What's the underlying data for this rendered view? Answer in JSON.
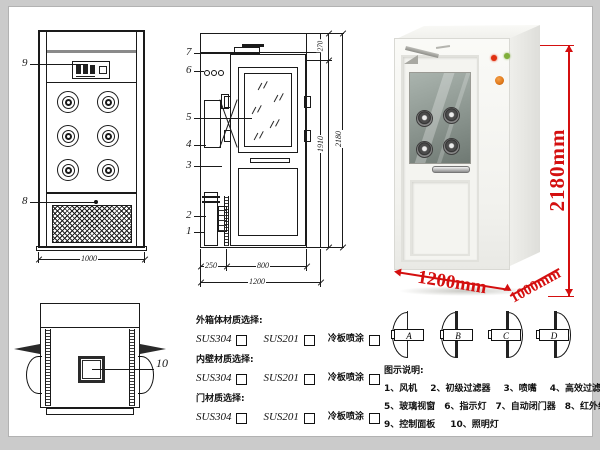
{
  "colors": {
    "line": "#1a1a1a",
    "dimension_red": "#d40f0f",
    "indicator_red": "#e03010",
    "indicator_green": "#7fae3a",
    "button_orange": "#e07818",
    "glass": "#8e9a94"
  },
  "front_view": {
    "label_9": "9",
    "label_8": "8",
    "width_dim": "1000"
  },
  "side_view": {
    "labels": [
      "7",
      "6",
      "5",
      "4",
      "3",
      "2",
      "1"
    ],
    "dim_270": "270",
    "dim_1910": "1910",
    "dim_2180": "2180",
    "dim_250": "250",
    "dim_800": "800",
    "dim_1200": "1200"
  },
  "photo": {
    "height": "2180mm",
    "width": "1200mm",
    "depth": "1000mm"
  },
  "top_view": {
    "label_10": "10"
  },
  "materials": {
    "groups": [
      {
        "title": "外箱体材质选择:",
        "options": [
          "SUS304",
          "SUS201",
          "冷板喷涂"
        ]
      },
      {
        "title": "内壁材质选择:",
        "options": [
          "SUS304",
          "SUS201",
          "冷板喷涂"
        ]
      },
      {
        "title": "门材质选择:",
        "options": [
          "SUS304",
          "SUS201",
          "冷板喷涂"
        ]
      }
    ]
  },
  "door_options": {
    "labels": [
      "A",
      "B",
      "C",
      "D"
    ]
  },
  "legend": {
    "title": "图示说明:",
    "items": [
      "1、风机",
      "2、初级过滤器",
      "3、喷嘴",
      "4、高效过滤器",
      "5、玻璃视窗",
      "6、指示灯",
      "7、自动闭门器",
      "8、红外线感应器",
      "9、控制面板",
      "10、照明灯"
    ]
  }
}
